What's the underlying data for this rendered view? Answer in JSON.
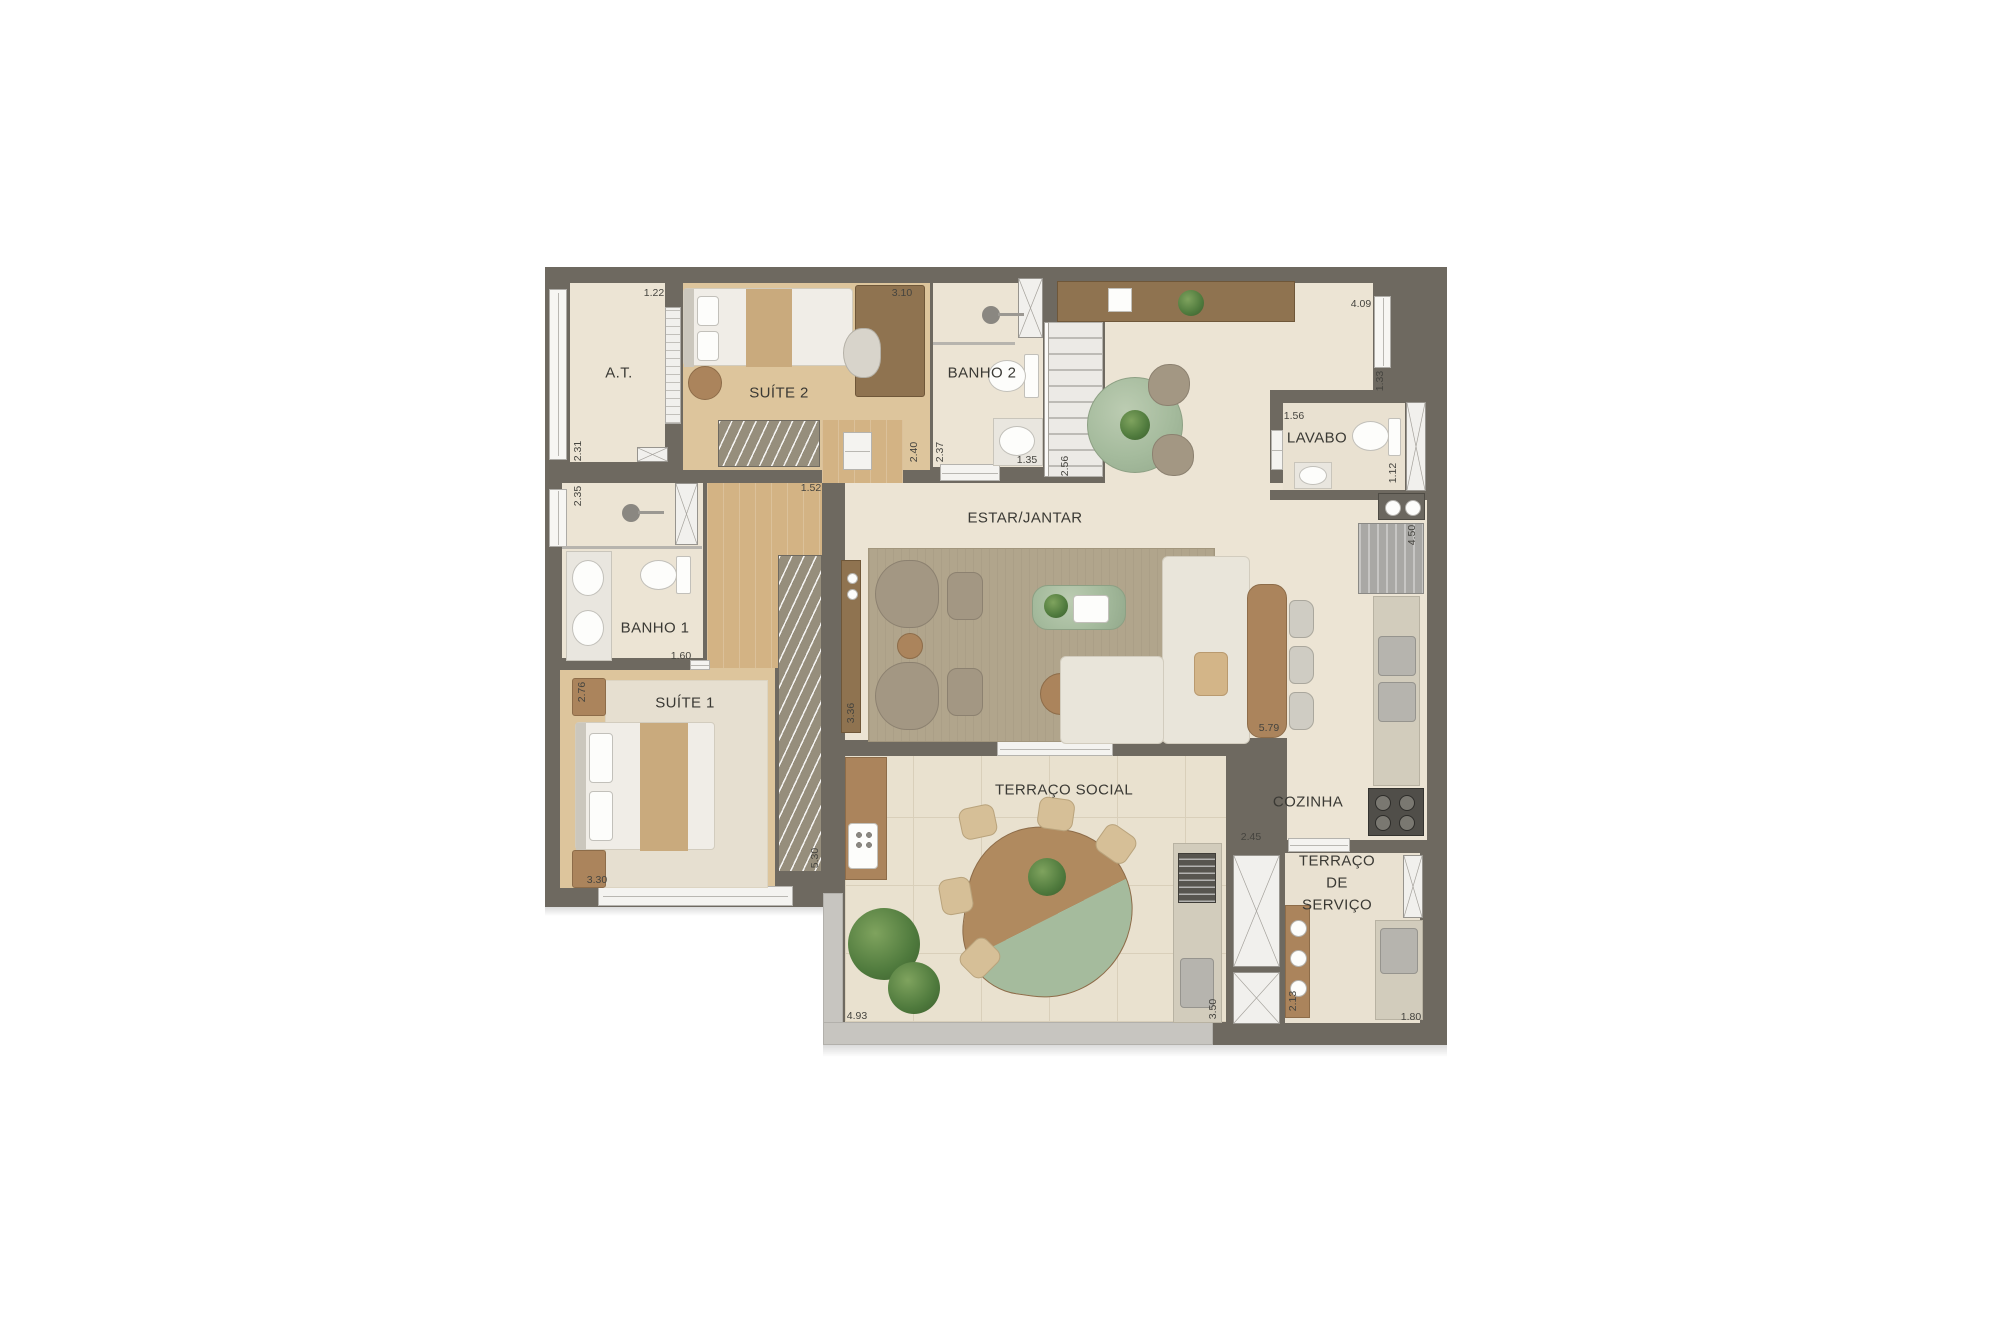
{
  "plan_title": "apartment-floor-plan",
  "colors": {
    "wall": "#6e6960",
    "parapet": "#c7c5c0",
    "floor_tile": "#ece4d4",
    "floor_wood": "#d3b384",
    "terrace_tile": "#e9e1cf",
    "marble_green": "#a5bb9d",
    "furniture_wood": "#ab845c",
    "upholstery_cream": "#e9e5da",
    "label_text": "#3a3934"
  },
  "rooms": [
    {
      "id": "at",
      "label": "A.T."
    },
    {
      "id": "suite2",
      "label": "SUÍTE 2"
    },
    {
      "id": "banho2",
      "label": "BANHO 2"
    },
    {
      "id": "lavabo",
      "label": "LAVABO"
    },
    {
      "id": "estar_jantar",
      "label": "ESTAR/JANTAR"
    },
    {
      "id": "banho1",
      "label": "BANHO 1"
    },
    {
      "id": "suite1",
      "label": "SUÍTE 1"
    },
    {
      "id": "cozinha",
      "label": "COZINHA"
    },
    {
      "id": "terraco_social",
      "label": "TERRAÇO SOCIAL"
    },
    {
      "id": "terraco_servico",
      "label": "TERRAÇO DE SERVIÇO"
    }
  ],
  "dimensions": [
    {
      "v": "1.22"
    },
    {
      "v": "3.10"
    },
    {
      "v": "4.09"
    },
    {
      "v": "1.33"
    },
    {
      "v": "1.56"
    },
    {
      "v": "1.12"
    },
    {
      "v": "4.50"
    },
    {
      "v": "2.40"
    },
    {
      "v": "2.37"
    },
    {
      "v": "1.35"
    },
    {
      "v": "2.56"
    },
    {
      "v": "1.52"
    },
    {
      "v": "3.36"
    },
    {
      "v": "5.79"
    },
    {
      "v": "5.30"
    },
    {
      "v": "1.60"
    },
    {
      "v": "2.31"
    },
    {
      "v": "2.35"
    },
    {
      "v": "2.76"
    },
    {
      "v": "3.30"
    },
    {
      "v": "4.93"
    },
    {
      "v": "3.50"
    },
    {
      "v": "2.45"
    },
    {
      "v": "2.13"
    },
    {
      "v": "1.80"
    }
  ]
}
